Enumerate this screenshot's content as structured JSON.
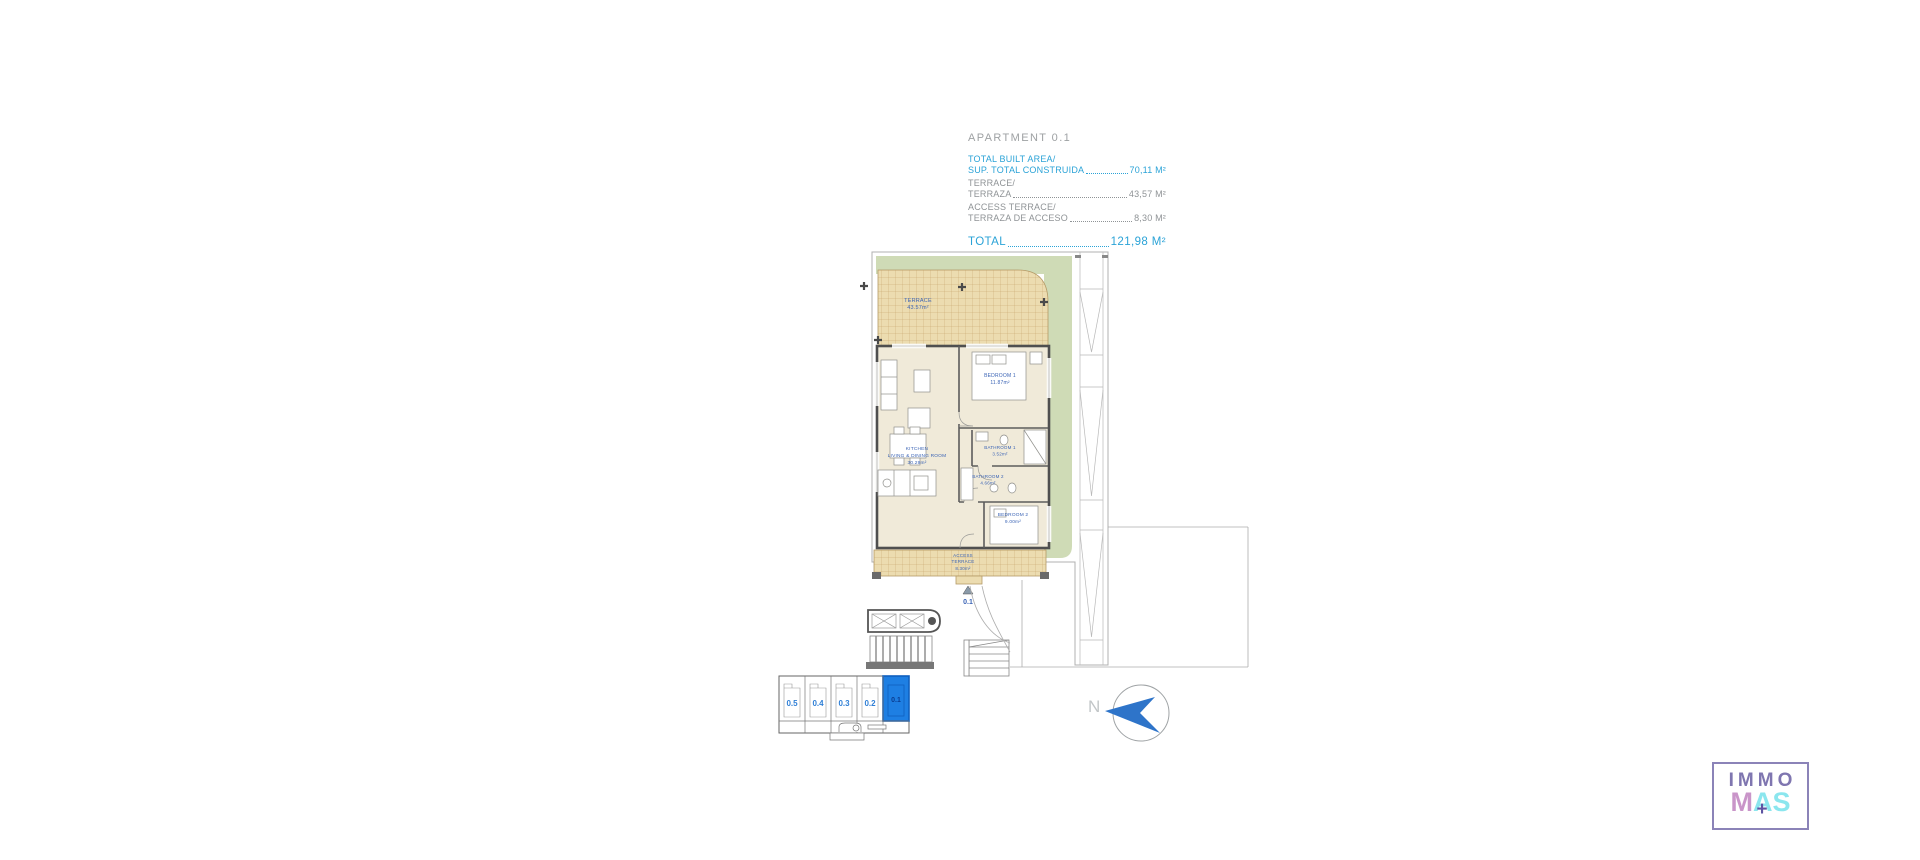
{
  "info_panel": {
    "title": "APARTMENT 0.1",
    "rows": [
      {
        "line1": "TOTAL BUILT AREA/",
        "line2": "SUP. TOTAL CONSTRUIDA",
        "value": "70,11 M²"
      },
      {
        "line1": "TERRACE/",
        "line2": "TERRAZA",
        "value": "43,57 M²"
      },
      {
        "line1": "ACCESS TERRACE/",
        "line2": "TERRAZA DE ACCESO",
        "value": "8,30 M²"
      }
    ],
    "total": {
      "label": "TOTAL",
      "value": "121,98 M²"
    }
  },
  "floor_plan": {
    "unit_marker": "0.1",
    "rooms": [
      {
        "name": "TERRACE",
        "area": "43.57m²"
      },
      {
        "name": "BEDROOM 1",
        "area": "11.87m²"
      },
      {
        "name": "BATHROOM 1",
        "area": "3.52m²"
      },
      {
        "name": "BATHROOM 2",
        "area": "4.66m²"
      },
      {
        "name": "KITCHEN",
        "name2": "LIVING & DINING ROOM",
        "area": "30.29m²"
      },
      {
        "name": "BEDROOM 2",
        "area": "9.00m²"
      },
      {
        "name": "ACCESS",
        "name2": "TERRACE",
        "area": "8.30m²"
      }
    ]
  },
  "key_plan": {
    "units": [
      {
        "label": "0.5",
        "active": false
      },
      {
        "label": "0.4",
        "active": false
      },
      {
        "label": "0.3",
        "active": false
      },
      {
        "label": "0.2",
        "active": false
      },
      {
        "label": "0.1",
        "active": true
      }
    ]
  },
  "compass": {
    "label": "N"
  },
  "logo": {
    "top": "IMMO",
    "m": "M",
    "a": "A",
    "s": "S",
    "plus": "+"
  },
  "colors": {
    "accent_blue": "#2BA3D7",
    "plan_label_blue": "#3A63B5",
    "key_plan_active_blue": "#1E7FE3",
    "compass_blue": "#2E74C9",
    "garden_green": "#CFDBB6",
    "terrace_tan": "#ECDCB0",
    "logo_purple": "#7F76B0",
    "logo_pink": "#C995C9",
    "logo_cyan": "#8BE6EE"
  }
}
